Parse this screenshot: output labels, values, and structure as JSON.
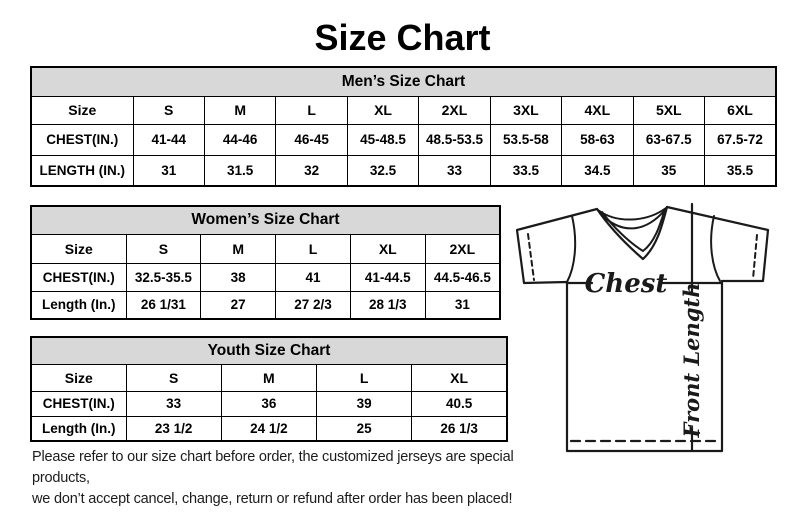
{
  "page": {
    "title": "Size Chart"
  },
  "colors": {
    "table_header_bg": "#d8d8d8",
    "border": "#000000",
    "line": "#1a1a1a"
  },
  "tables": [
    {
      "title": "Men’s Size Chart",
      "header_row": [
        "Size",
        "S",
        "M",
        "L",
        "XL",
        "2XL",
        "3XL",
        "4XL",
        "5XL",
        "6XL"
      ],
      "rows": [
        [
          "CHEST(IN.)",
          "41-44",
          "44-46",
          "46-45",
          "45-48.5",
          "48.5-53.5",
          "53.5-58",
          "58-63",
          "63-67.5",
          "67.5-72"
        ],
        [
          "LENGTH (IN.)",
          "31",
          "31.5",
          "32",
          "32.5",
          "33",
          "33.5",
          "34.5",
          "35",
          "35.5"
        ]
      ]
    },
    {
      "title": "Women’s Size Chart",
      "header_row": [
        "Size",
        "S",
        "M",
        "L",
        "XL",
        "2XL"
      ],
      "rows": [
        [
          "CHEST(IN.)",
          "32.5-35.5",
          "38",
          "41",
          "41-44.5",
          "44.5-46.5"
        ],
        [
          "Length (In.)",
          "26 1/31",
          "27",
          "27 2/3",
          "28 1/3",
          "31"
        ]
      ]
    },
    {
      "title": "Youth Size Chart",
      "header_row": [
        "Size",
        "S",
        "M",
        "L",
        "XL"
      ],
      "rows": [
        [
          "CHEST(IN.)",
          "33",
          "36",
          "39",
          "40.5"
        ],
        [
          "Length (In.)",
          "23 1/2",
          "24 1/2",
          "25",
          "26 1/3"
        ]
      ]
    }
  ],
  "diagram": {
    "chest_label": "Chest",
    "front_length_label": "Front Length"
  },
  "footer": {
    "line1": "Please refer to our size chart before order, the customized jerseys are special products,",
    "line2": "we don’t accept cancel, change, return or refund after order has been placed!"
  }
}
